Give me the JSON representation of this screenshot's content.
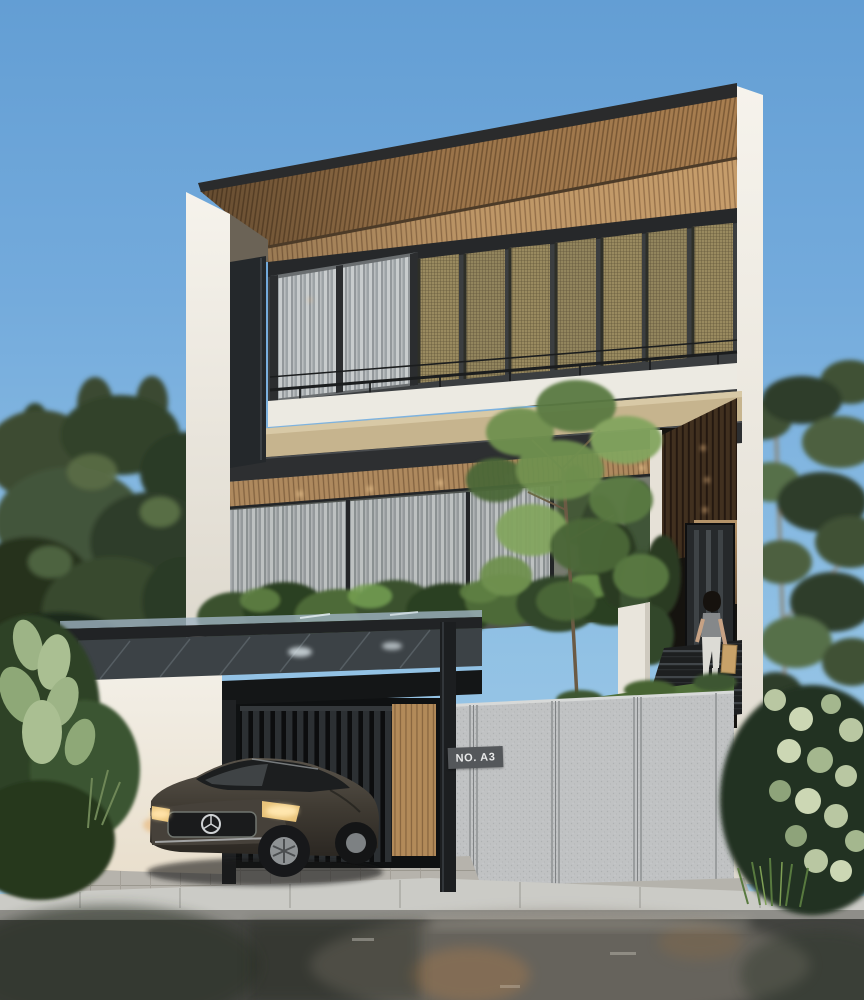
{
  "scene": {
    "type": "natural-image",
    "subject": "modern-tropical-three-storey-house-exterior-render",
    "sign": {
      "text": "NO. A3",
      "background": "#54575a",
      "color": "#e8e9e9"
    },
    "palette": {
      "sky_top": "#639ed4",
      "sky_bottom": "#a9cfe9",
      "wall_white": "#f3f0e9",
      "roof_wood": "#a87e50",
      "rattan_screen": "#998a5f",
      "metal_dark": "#26282a",
      "soffit_wood": "#c69d6b",
      "entrance_walnut": "#3f2d1f",
      "concrete_fence": "#c0c2c3",
      "foliage_dark": "#2f3d2a",
      "foliage_light": "#5d7048",
      "hedge_green": "#3a512e",
      "road_wet": "#42433f",
      "car_body": "#4a453c",
      "headlight_glow": "#e8c37a"
    },
    "objects": [
      "sloped-timber-roof-canopy",
      "rattan-pivot-screens",
      "balcony-railing",
      "glass-facade-with-curtains",
      "planter-hedge",
      "entrance-stairs",
      "pedestrian-with-shopping-bag",
      "carport-glass-canopy",
      "sedan-car",
      "slatted-gate",
      "timber-slat-wall",
      "concrete-panel-fence",
      "house-number-sign",
      "wet-asphalt-street",
      "trees-and-plants"
    ]
  }
}
